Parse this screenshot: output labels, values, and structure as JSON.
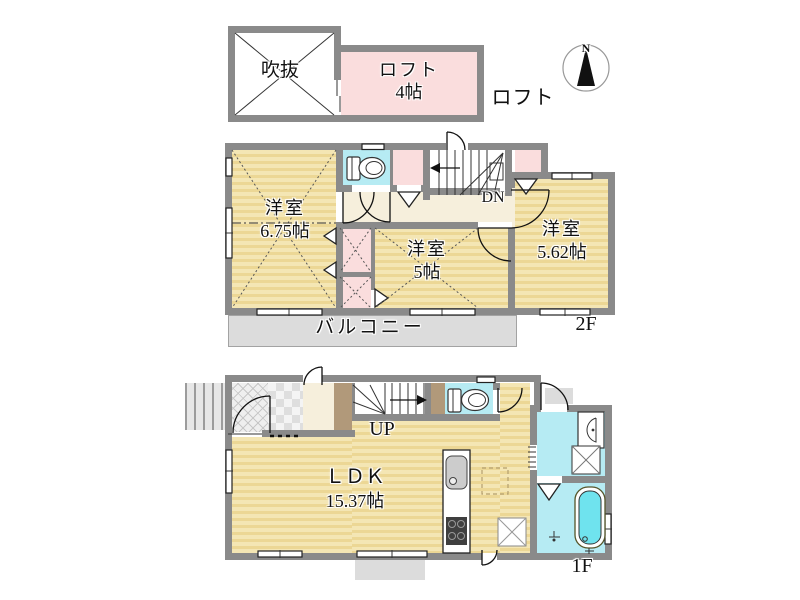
{
  "colors": {
    "wall": "#8a8a8a",
    "yellow_a": "#f4e6b4",
    "yellow_b": "#ecd795",
    "pink": "#fadddd",
    "cyan": "#b6ebf3",
    "cream": "#f6efdc",
    "balcony": "#dcdcdc",
    "brown": "#b1997a",
    "tub": "#6fe3ee"
  },
  "compass": {
    "north_label": "N"
  },
  "loft_level": {
    "void_label": "吹抜",
    "loft_name": "ロフト",
    "loft_size": "4帖",
    "level_label": "ロフト"
  },
  "floor_2f": {
    "room_west_name": "洋室",
    "room_west_size": "6.75帖",
    "room_center_name": "洋室",
    "room_center_size": "5帖",
    "room_east_name": "洋室",
    "room_east_size": "5.62帖",
    "stairs_label": "DN",
    "balcony_label": "バルコニー",
    "level_label": "2F"
  },
  "floor_1f": {
    "ldk_name": "ＬＤＫ",
    "ldk_size": "15.37帖",
    "stairs_label": "UP",
    "level_label": "1F"
  }
}
